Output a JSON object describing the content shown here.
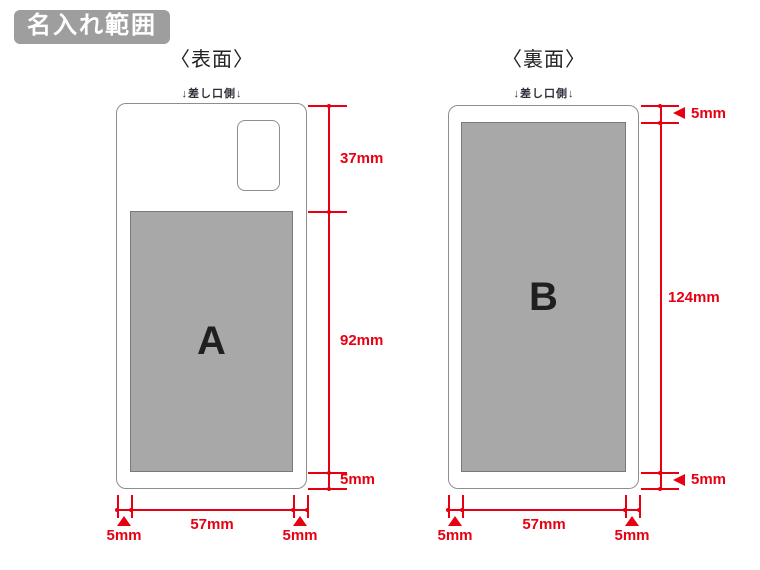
{
  "badge": {
    "label": "名入れ範囲"
  },
  "front": {
    "title": "〈表面〉",
    "insertion_side_label": "↓差し口側↓",
    "print_area_label": "A",
    "dims": {
      "top_height": "37mm",
      "area_height": "92mm",
      "bottom_margin": "5mm",
      "area_width": "57mm",
      "left_margin": "5mm",
      "right_margin": "5mm"
    }
  },
  "back": {
    "title": "〈裏面〉",
    "insertion_side_label": "↓差し口側↓",
    "print_area_label": "B",
    "dims": {
      "top_margin": "5mm",
      "area_height": "124mm",
      "bottom_margin": "5mm",
      "area_width": "57mm",
      "left_margin": "5mm",
      "right_margin": "5mm"
    }
  },
  "colors": {
    "dimension_red": "#e60012",
    "print_area_gray": "#a8a8a8",
    "badge_gray": "#9e9e9e"
  }
}
